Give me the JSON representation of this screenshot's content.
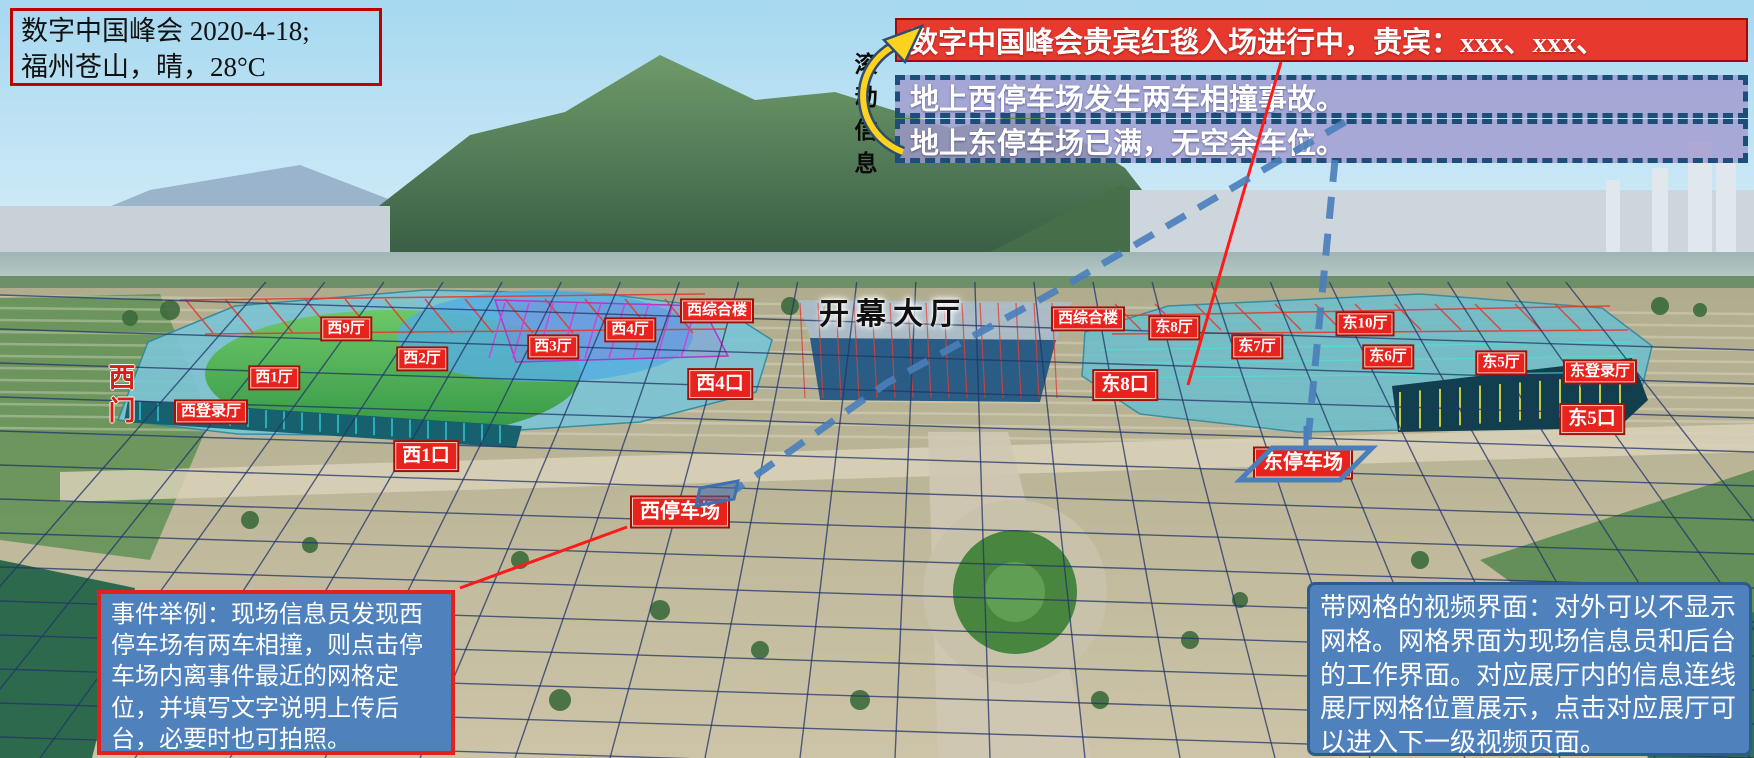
{
  "scene": {
    "width": 1754,
    "height": 758,
    "name": "数字中国峰会场馆网格视频界面"
  },
  "info_box": {
    "lines": [
      "数字中国峰会 2020-4-18;",
      "福州苍山，晴，28°C"
    ]
  },
  "ticker": {
    "label": "滚动信息",
    "vip_banner": {
      "id": "vip-red-carpet",
      "text": "数字中国峰会贵宾红毯入场进行中，贵宾：xxx、xxx、"
    },
    "messages": [
      {
        "id": "west-parking-accident",
        "text": "地上西停车场发生两车相撞事故。"
      },
      {
        "id": "east-parking-full",
        "text": "地上东停车场已满，无空余车位。"
      }
    ]
  },
  "map_labels": {
    "halls": [
      {
        "id": "hall-west-9",
        "label": "西9厅",
        "x": 346,
        "y": 329,
        "kind": "hall"
      },
      {
        "id": "hall-west-2",
        "label": "西2厅",
        "x": 422,
        "y": 359,
        "kind": "hall"
      },
      {
        "id": "hall-west-1",
        "label": "西1厅",
        "x": 274,
        "y": 378,
        "kind": "hall"
      },
      {
        "id": "hall-west-login",
        "label": "西登录厅",
        "x": 211,
        "y": 412,
        "kind": "hall"
      },
      {
        "id": "hall-west-3",
        "label": "西3厅",
        "x": 553,
        "y": 347,
        "kind": "hall"
      },
      {
        "id": "hall-west-4",
        "label": "西4厅",
        "x": 630,
        "y": 330,
        "kind": "hall"
      },
      {
        "id": "hall-west-complex",
        "label": "西综合楼",
        "x": 717,
        "y": 311,
        "kind": "hall"
      },
      {
        "id": "hall-west-complex-2",
        "label": "西综合楼",
        "x": 1088,
        "y": 319,
        "kind": "hall"
      },
      {
        "id": "hall-east-8",
        "label": "东8厅",
        "x": 1174,
        "y": 328,
        "kind": "hall"
      },
      {
        "id": "hall-east-7",
        "label": "东7厅",
        "x": 1257,
        "y": 347,
        "kind": "hall"
      },
      {
        "id": "hall-east-10",
        "label": "东10厅",
        "x": 1365,
        "y": 324,
        "kind": "hall"
      },
      {
        "id": "hall-east-6",
        "label": "东6厅",
        "x": 1388,
        "y": 357,
        "kind": "hall"
      },
      {
        "id": "hall-east-5",
        "label": "东5厅",
        "x": 1501,
        "y": 363,
        "kind": "hall"
      },
      {
        "id": "hall-east-login",
        "label": "东登录厅",
        "x": 1600,
        "y": 372,
        "kind": "hall"
      },
      {
        "id": "entrance-west-4",
        "label": "西4口",
        "x": 720,
        "y": 384,
        "kind": "entrance"
      },
      {
        "id": "entrance-west-1",
        "label": "西1口",
        "x": 426,
        "y": 456,
        "kind": "entrance"
      },
      {
        "id": "entrance-east-8",
        "label": "东8口",
        "x": 1125,
        "y": 385,
        "kind": "entrance"
      },
      {
        "id": "entrance-east-5",
        "label": "东5口",
        "x": 1592,
        "y": 419,
        "kind": "entrance"
      },
      {
        "id": "parking-west",
        "label": "西停车场",
        "x": 680,
        "y": 512,
        "kind": "parking"
      },
      {
        "id": "parking-east",
        "label": "东停车场",
        "x": 1303,
        "y": 463,
        "kind": "parking"
      }
    ],
    "main_title": {
      "id": "hall-opening",
      "label": "开幕大厅",
      "x": 893,
      "y": 311
    },
    "west_gate": {
      "id": "gate-west",
      "label": "西门",
      "x": 120,
      "y": 396
    }
  },
  "notes": {
    "event_example": {
      "text": "事件举例：现场信息员发现西停车场有两车相撞，则点击停车场内离事件最近的网格定位，并填写文字说明上传后台，必要时也可拍照。"
    },
    "grid_view": {
      "text": "带网格的视频界面：对外可以不显示网格。网格界面为现场信息员和后台的工作界面。对应展厅内的信息连线展厅网格位置展示，点击对应展厅可以进入下一级视频页面。"
    }
  },
  "colors": {
    "accent_red": "#e8231d",
    "banner_red": "#e8392f",
    "note_blue": "#4f81bd",
    "dashed_border_navy": "#1d4e79",
    "ticker_purple": "#a098cd",
    "grid_navy": "#223468",
    "link_line_blue": "#4a7ebb",
    "link_line_red": "#ff1a1a",
    "arrow_yellow": "#ffd21f"
  },
  "icons": {
    "scroll_arrow": "curved-cycle-arrow"
  }
}
